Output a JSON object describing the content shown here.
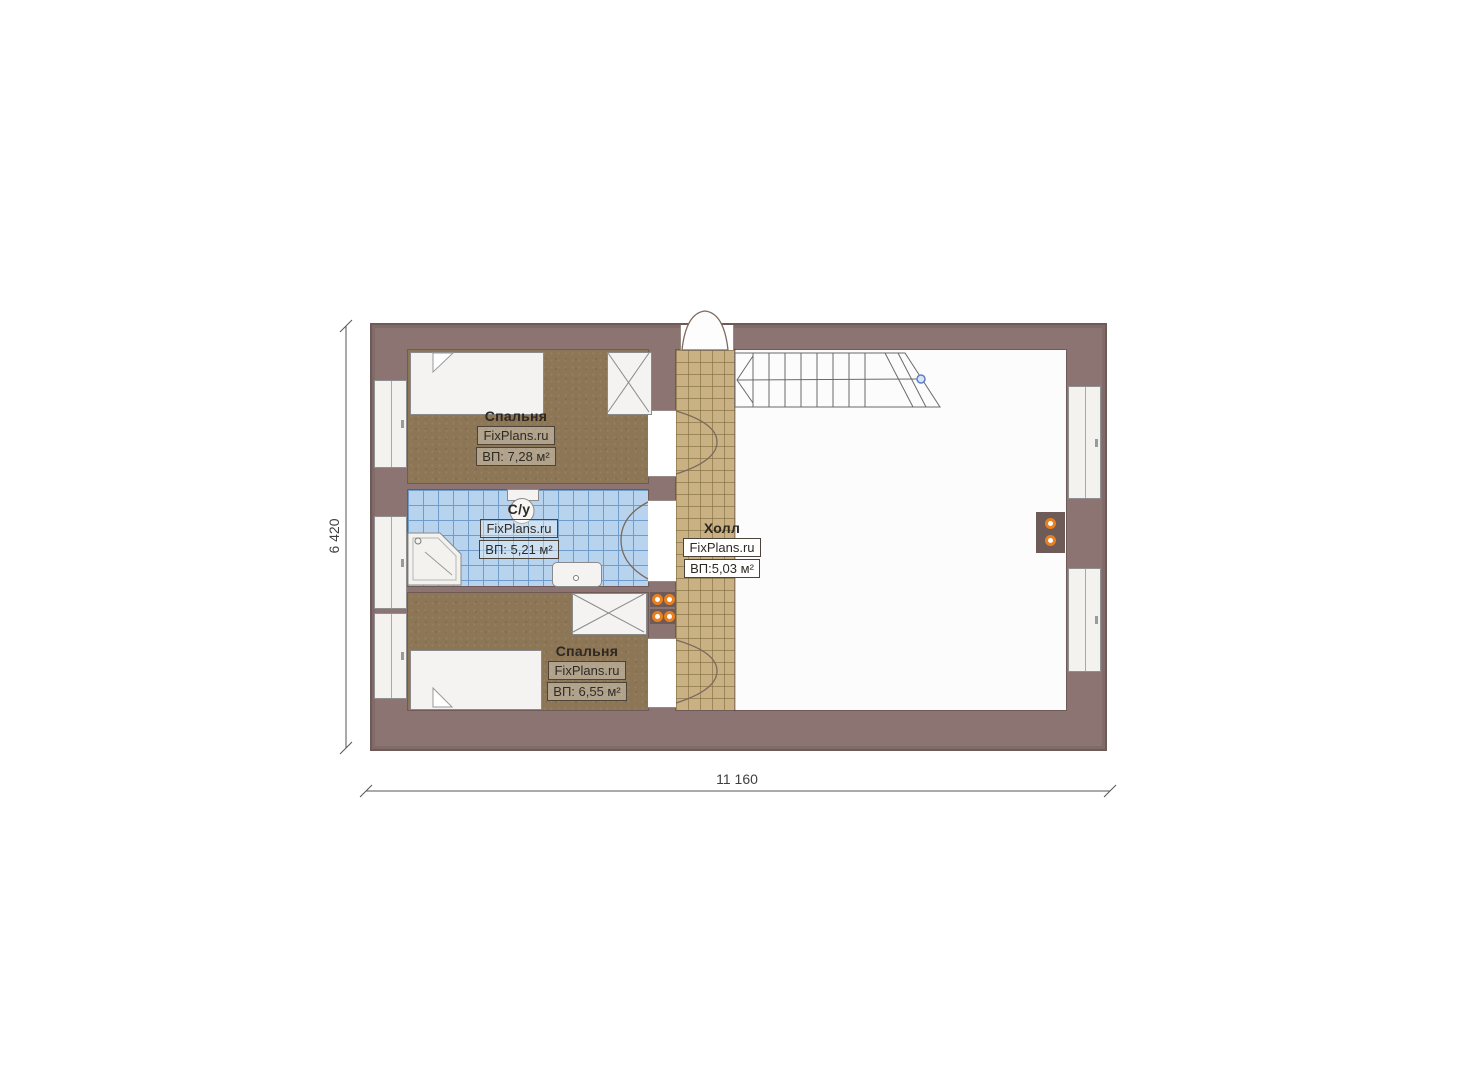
{
  "page": {
    "background": "#ffffff"
  },
  "plan": {
    "watermark": "FixPlans.ru",
    "dimensions": {
      "height_label": "6 420",
      "width_label": "11 160"
    },
    "rooms": [
      {
        "id": "bedroom-top",
        "name": "Спальня",
        "watermark": "FixPlans.ru",
        "area_label": "ВП: 7,28 м²"
      },
      {
        "id": "bathroom",
        "name": "С/у",
        "watermark": "FixPlans.ru",
        "area_label": "ВП: 5,21 м²"
      },
      {
        "id": "hall",
        "name": "Холл",
        "watermark": "FixPlans.ru",
        "area_label": "ВП:5,03 м²"
      },
      {
        "id": "bedroom-bottom",
        "name": "Спальня",
        "watermark": "FixPlans.ru",
        "area_label": "ВП: 6,55 м²"
      }
    ],
    "features": {
      "stairs": "winder-staircase",
      "fixtures": [
        "corner-shower",
        "toilet",
        "washbasin"
      ],
      "furniture": [
        "bed",
        "bed",
        "wardrobe",
        "wardrobe"
      ],
      "radiators": 3,
      "windows_left": 3,
      "windows_right": 2
    },
    "colors": {
      "wall": "#8b7471",
      "carpet": "#8d7655",
      "bath_tile": "#b7d3ee",
      "bath_grid": "#6f9cc8",
      "hall_tile": "#c9b183",
      "floor": "#fcfcfc",
      "radiator_accent": "#e8801f",
      "stair_node": "#5b7fce"
    }
  }
}
